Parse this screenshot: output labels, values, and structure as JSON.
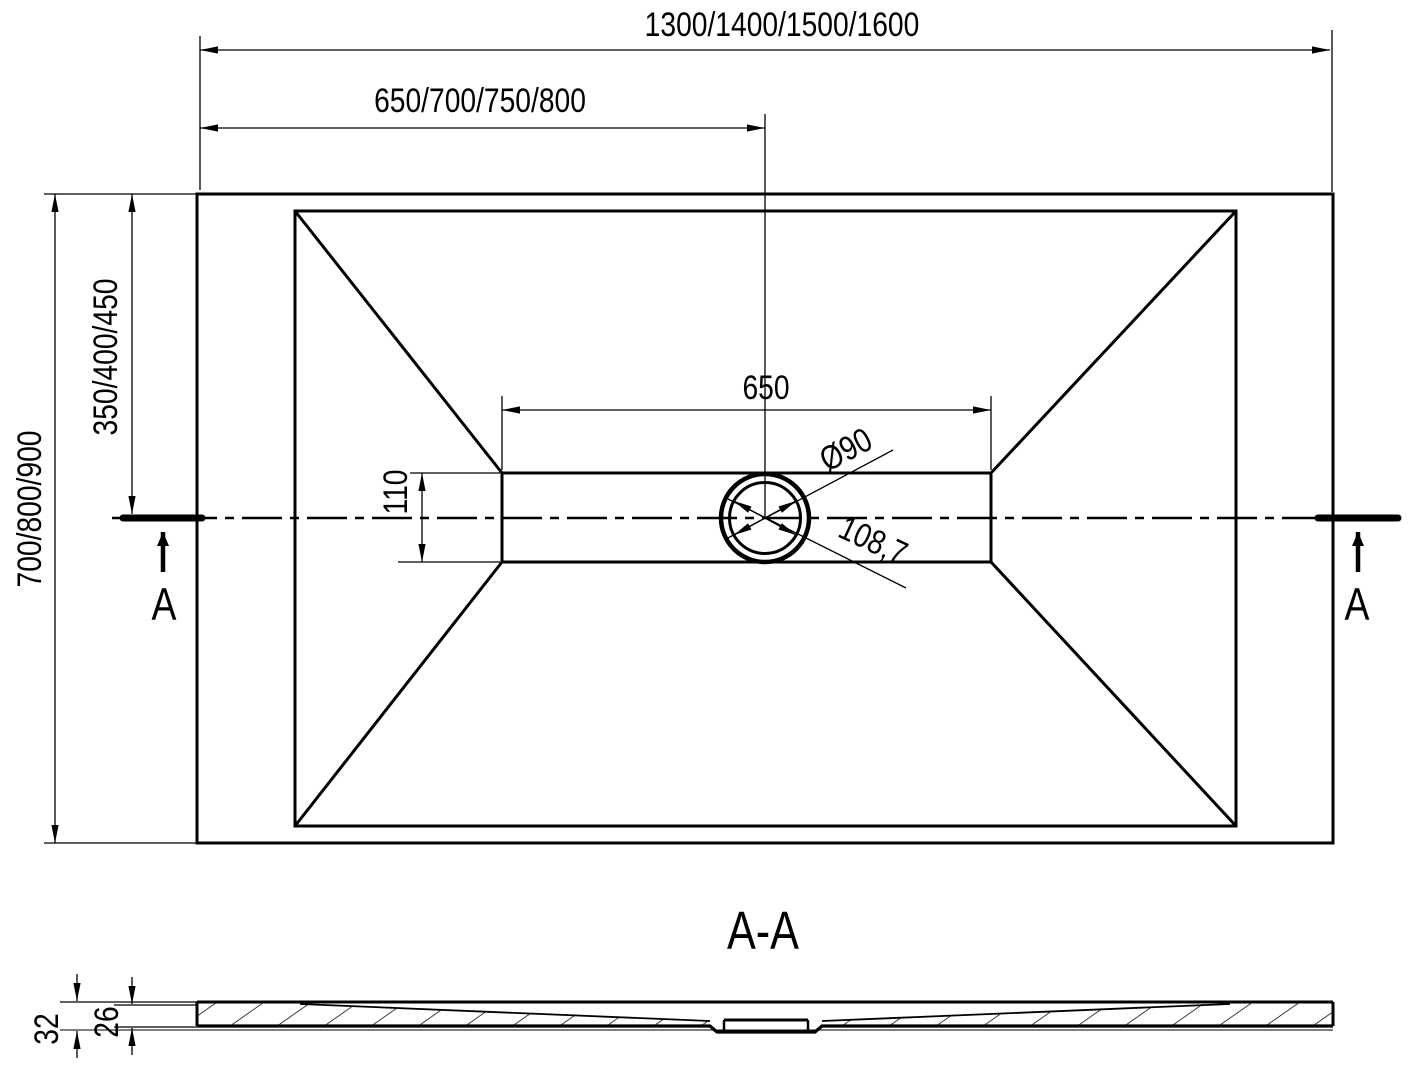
{
  "top_view": {
    "dim_width_overall": "1300/1400/1500/1600",
    "dim_width_half": "650/700/750/800",
    "dim_height_overall": "700/800/900",
    "dim_height_half": "350/400/450",
    "dim_inner_width": "650",
    "dim_inner_height": "110",
    "dim_drain_diameter": "Ø90",
    "dim_drain_flange_diagonal": "108,7",
    "section_marker_left": "A",
    "section_marker_right": "A"
  },
  "section_view": {
    "title": "A-A",
    "dim_total_thickness": "32",
    "dim_body_thickness": "26"
  },
  "colors": {
    "line": "#000000",
    "background": "#ffffff"
  }
}
